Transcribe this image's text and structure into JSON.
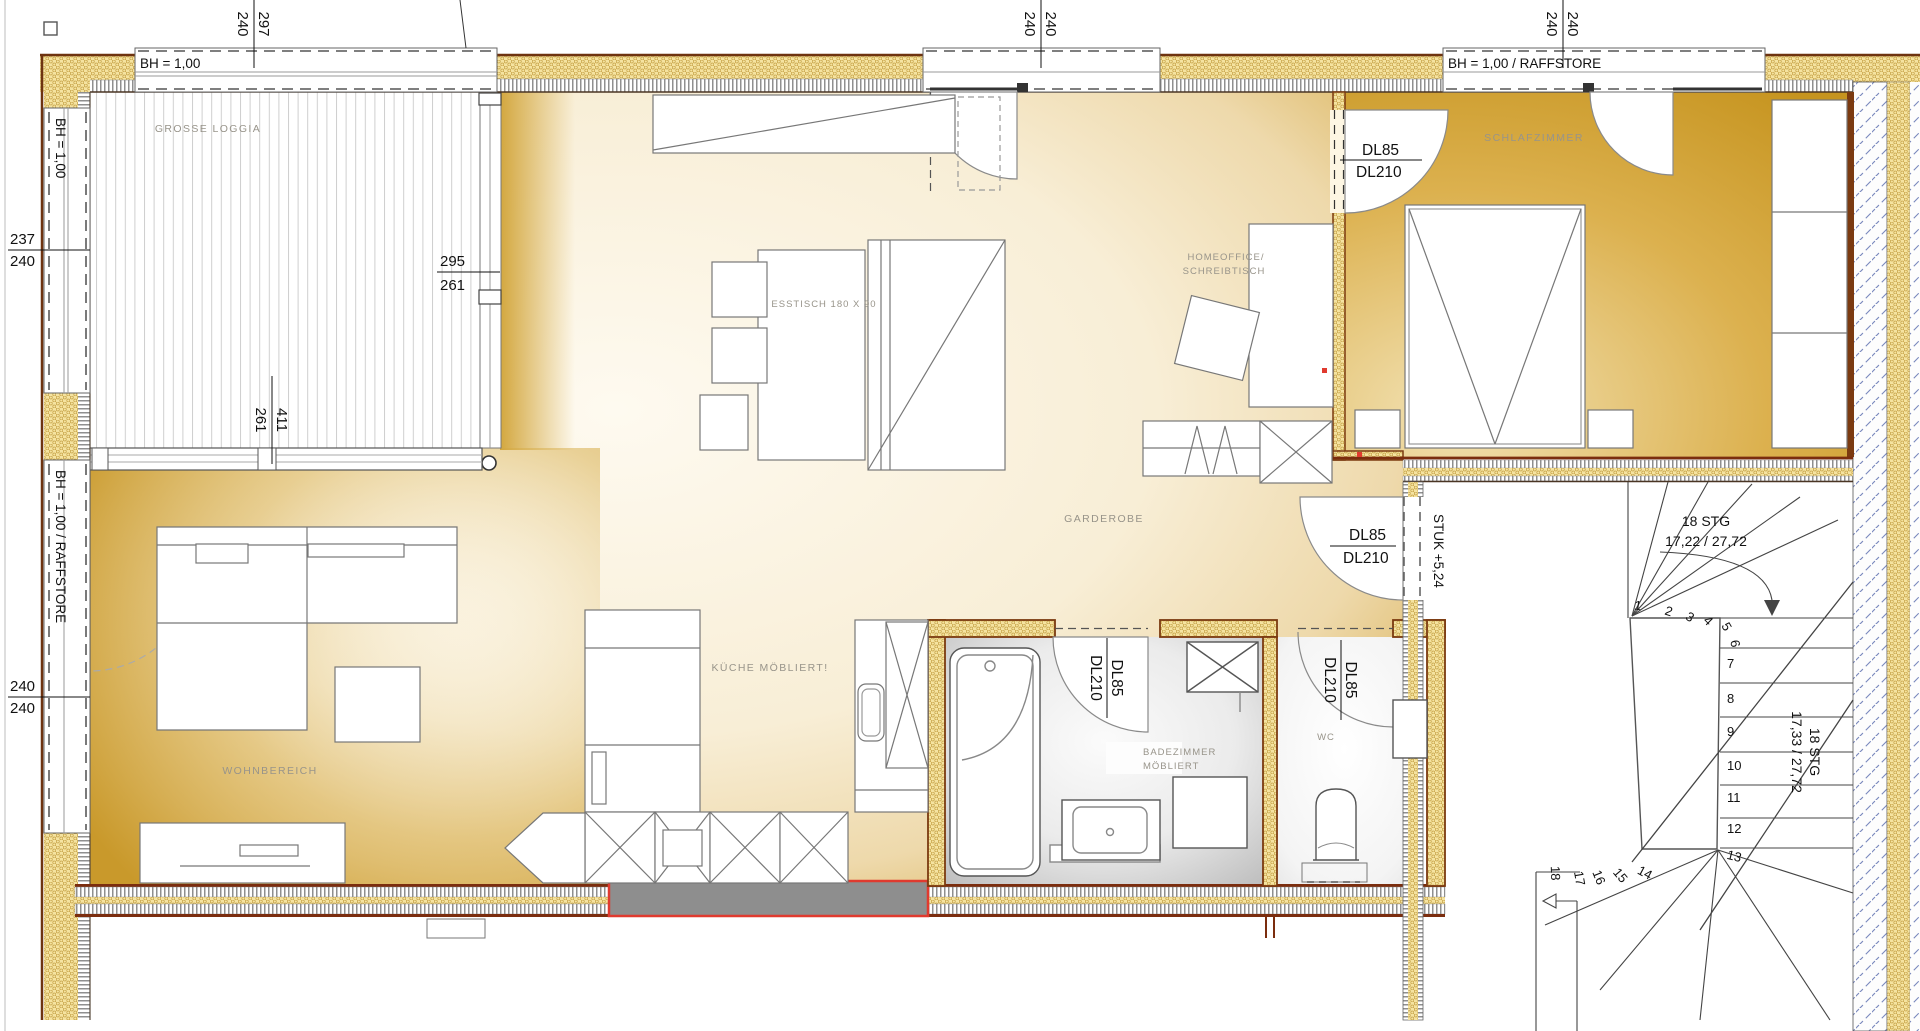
{
  "plan": {
    "title": "floor-plan",
    "rooms": {
      "loggia": "GROSSE LOGGIA",
      "wohnbereich": "WOHNBEREICH",
      "kueche": "KÜCHE MÖBLIERT!",
      "esstisch": "ESSTISCH 180 X 90",
      "homeoffice_line1": "HOMEOFFICE/",
      "homeoffice_line2": "SCHREIBTISCH",
      "schlafzimmer": "SCHLAFZIMMER",
      "garderobe": "GARDEROBE",
      "bad_line1": "BADEZIMMER",
      "bad_line2": "MÖBLIERT",
      "wc": "WC"
    },
    "windows": {
      "bh100": "BH = 1,00",
      "bh100_raffstore": "BH = 1,00 / RAFFSTORE"
    },
    "doors": {
      "dl85": "DL85",
      "dl210": "DL210"
    },
    "stair": {
      "top_label_line1": "18 STG",
      "top_label_line2": "17,22 / 27,72",
      "side_label_line1": "18 STG",
      "side_label_line2": "17,33 / 27,72",
      "level": "STUK +5,24",
      "steps": [
        "1",
        "2",
        "3",
        "4",
        "5",
        "6",
        "7",
        "8",
        "9",
        "10",
        "11",
        "12",
        "13",
        "14",
        "15",
        "16",
        "17",
        "18"
      ]
    },
    "dimensions": {
      "d297": "297",
      "d240": "240",
      "d237": "237",
      "d295": "295",
      "d261": "261",
      "d411": "411"
    },
    "colors": {
      "floor_gold": "#c9992b",
      "hatch_yellow": "#f5e3a0",
      "wall_brown": "#7b3a10",
      "neighbor_blue": "#7988bd",
      "bath_gray": "#bfbfbf",
      "accent_red": "#e03a2f"
    }
  }
}
